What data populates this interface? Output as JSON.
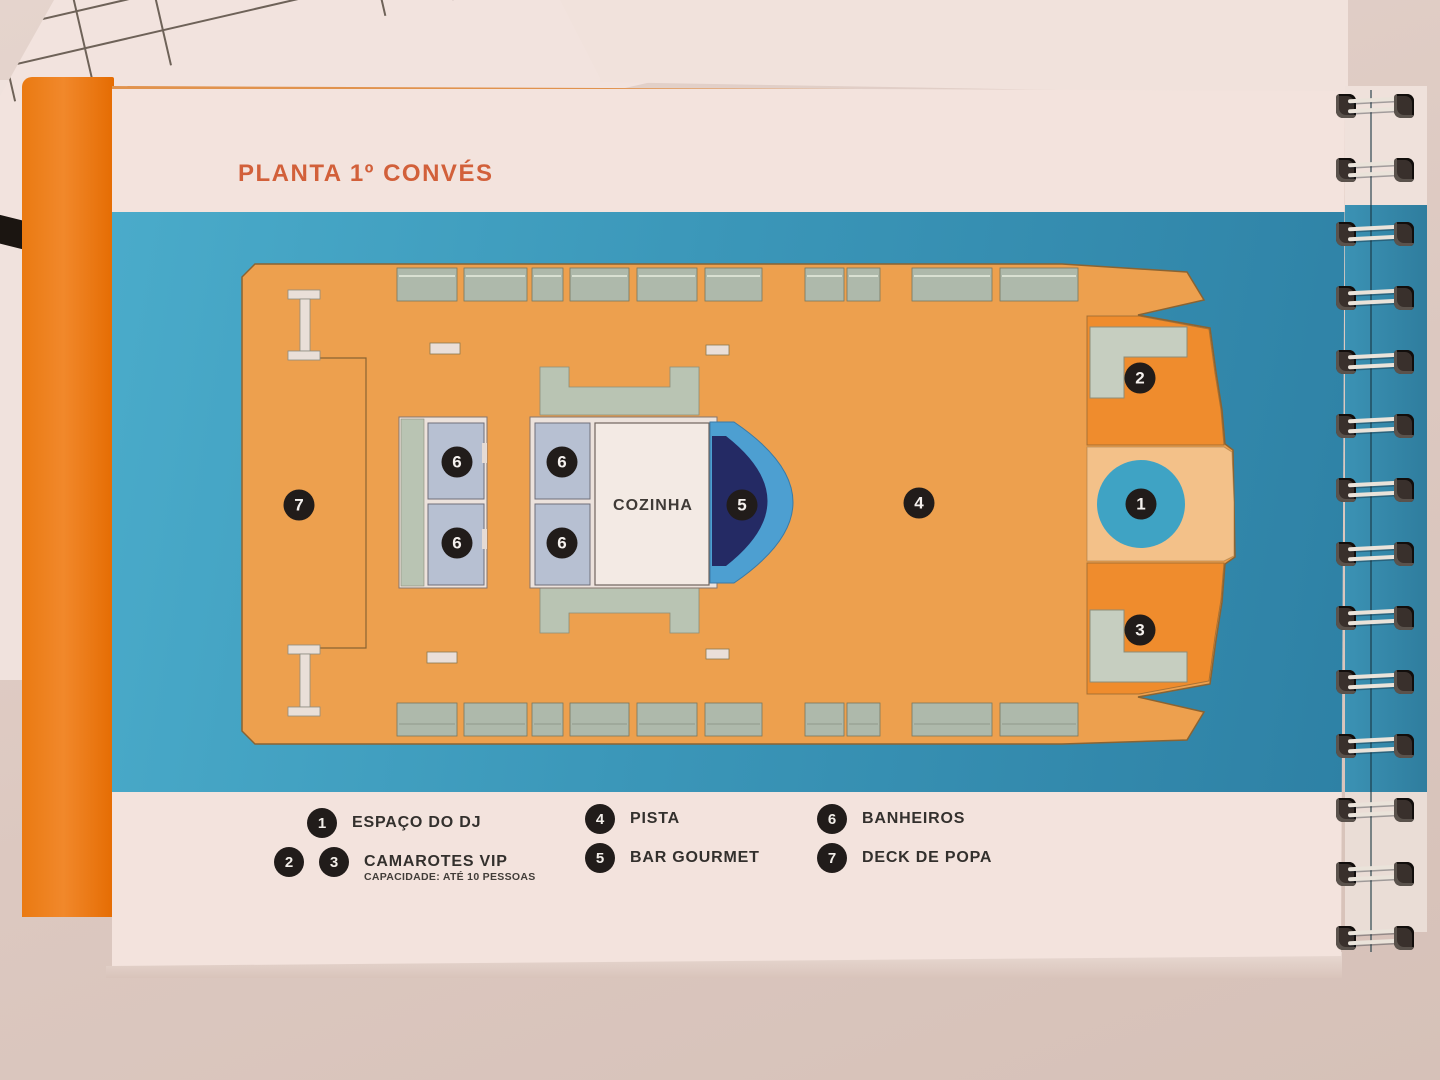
{
  "page": {
    "title": "PLANTA 1º CONVÉS"
  },
  "plan": {
    "kitchen_label": "COZINHA",
    "markers": {
      "m1": "1",
      "m2": "2",
      "m3": "3",
      "m4": "4",
      "m5": "5",
      "m6": "6",
      "m7": "7"
    }
  },
  "legend": {
    "item1": {
      "num": "1",
      "label": "ESPAÇO DO DJ"
    },
    "item23": {
      "num2": "2",
      "num3": "3",
      "label": "CAMAROTES VIP",
      "sub": "CAPACIDADE: ATÉ 10 PESSOAS"
    },
    "item4": {
      "num": "4",
      "label": "PISTA"
    },
    "item5": {
      "num": "5",
      "label": "BAR GOURMET"
    },
    "item6": {
      "num": "6",
      "label": "BANHEIROS"
    },
    "item7": {
      "num": "7",
      "label": "DECK DE POPA"
    }
  },
  "side_papers": {
    "header1": "CRÉDITO A FAVOR DE ARLES",
    "header2": "A PAGAR",
    "header3": "SAL",
    "cells": [
      "13",
      "13",
      "13",
      "11"
    ],
    "badge": "TO"
  },
  "colors": {
    "title_orange": "#d2603a",
    "band_blue": "#3b97b9",
    "deck_orange": "#eda04e",
    "vip_orange": "#ef8c2d",
    "bow_peach": "#f3c189",
    "bench_green": "#aeb9ab",
    "bathroom_blue": "#b7c0d2",
    "bar_navy": "#242a64",
    "bar_blue": "#4d9fd1",
    "dj_blue": "#3fa3c4",
    "marker_black": "#211c1a",
    "cover_orange": "#ed7c17"
  }
}
